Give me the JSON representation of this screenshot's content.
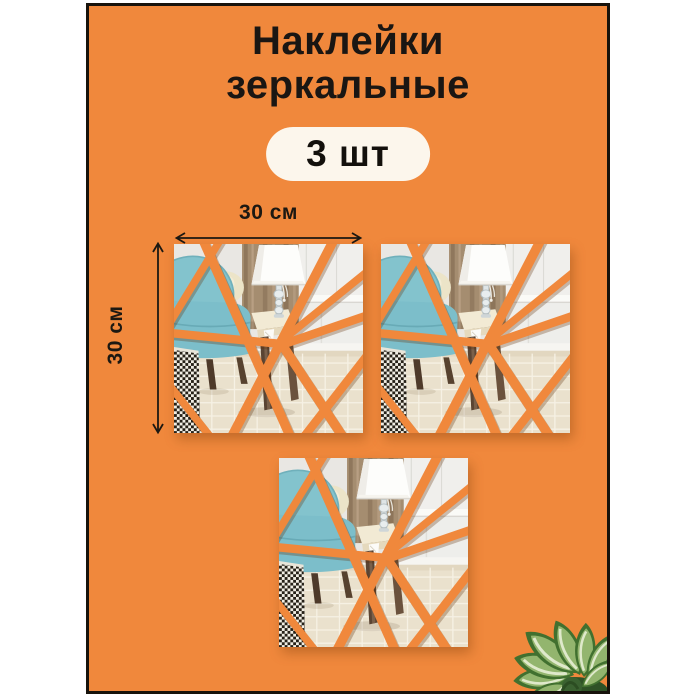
{
  "product_card": {
    "title_line1": "Наклейки",
    "title_line2": "зеркальные",
    "quantity_badge": "3 шт",
    "background_color": "#f0883c",
    "border_color": "#17130c",
    "badge_background": "#fcf6ec",
    "text_color": "#1a1613"
  },
  "dimensions": {
    "width_label": "30 см",
    "height_label": "30 см"
  },
  "stickers": {
    "count": 3
  }
}
